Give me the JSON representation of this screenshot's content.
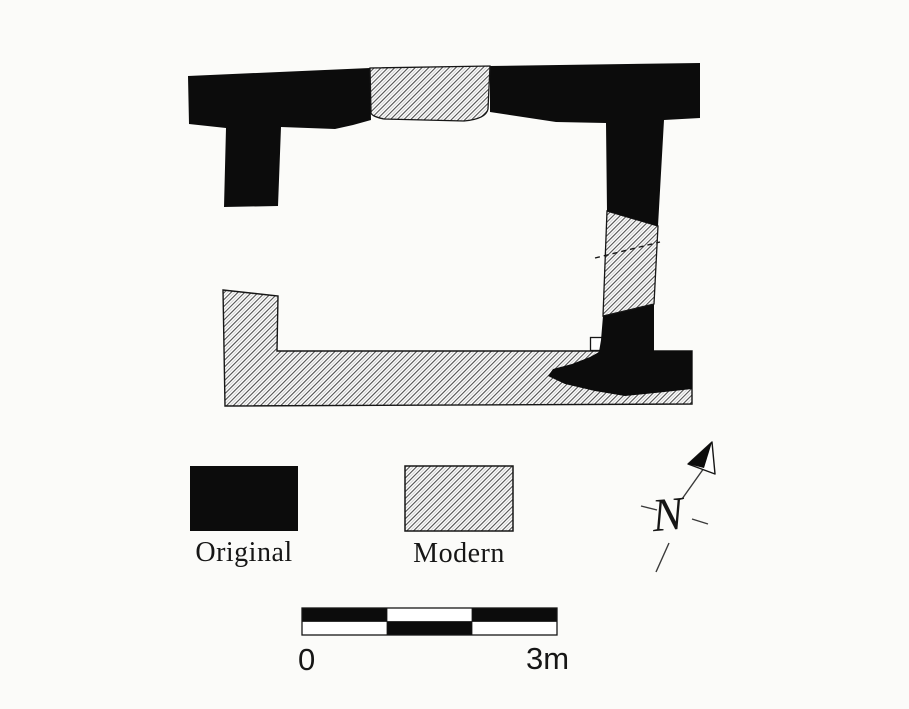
{
  "figure": {
    "kind": "archaeological-building-plan",
    "note": "Plan of a roughly rectangular structure; solid black walls are original masonry, diagonally hatched walls are modern rebuilds."
  },
  "legend": {
    "items": [
      {
        "label": "Original",
        "swatch": "solid-black"
      },
      {
        "label": "Modern",
        "swatch": "diagonal-hatch"
      }
    ]
  },
  "north_arrow": {
    "label": "N"
  },
  "scale_bar": {
    "start_label": "0",
    "end_label": "3m",
    "top_row": [
      "black",
      "white",
      "black"
    ],
    "bottom_row": [
      "white",
      "black",
      "white"
    ]
  },
  "colors": {
    "wall_original": "#0c0c0c",
    "hatch_line_dark": "#3b3b3b",
    "hatch_line_light": "#c4c4c4",
    "outline": "#161616",
    "background": "#fbfbf9"
  }
}
